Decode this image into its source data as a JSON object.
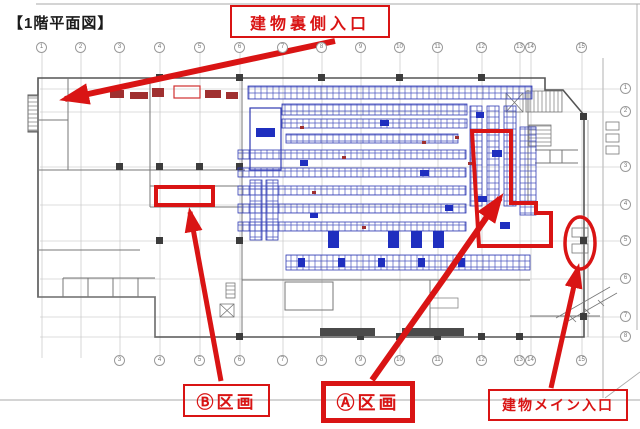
{
  "title": "【1階平面図】",
  "annotations": {
    "back_entrance": "建物裏側入口",
    "section_b": "Ⓑ区画",
    "section_a": "Ⓐ区画",
    "main_entrance": "建物メイン入口"
  },
  "colors": {
    "annotation_red": "#d91414",
    "plan_blue": "#2f3ab2",
    "plan_blue_solid": "#1f2fbf",
    "equipment_red": "#a03030",
    "wall_gray": "#555555",
    "grid_gray": "#9a9a9a"
  },
  "grid": {
    "top_columns": [
      {
        "label": "1",
        "x": 42
      },
      {
        "label": "2",
        "x": 81
      },
      {
        "label": "3",
        "x": 120
      },
      {
        "label": "4",
        "x": 160
      },
      {
        "label": "5",
        "x": 200
      },
      {
        "label": "6",
        "x": 240
      },
      {
        "label": "7",
        "x": 283
      },
      {
        "label": "8",
        "x": 322
      },
      {
        "label": "9",
        "x": 361
      },
      {
        "label": "10",
        "x": 400
      },
      {
        "label": "11",
        "x": 438
      },
      {
        "label": "12",
        "x": 482
      },
      {
        "label": "13",
        "x": 520
      },
      {
        "label": "14",
        "x": 531
      },
      {
        "label": "15",
        "x": 582
      }
    ],
    "bottom_columns": [
      {
        "label": "3",
        "x": 120
      },
      {
        "label": "4",
        "x": 160
      },
      {
        "label": "5",
        "x": 200
      },
      {
        "label": "6",
        "x": 240
      },
      {
        "label": "7",
        "x": 283
      },
      {
        "label": "8",
        "x": 322
      },
      {
        "label": "9",
        "x": 361
      },
      {
        "label": "10",
        "x": 400
      },
      {
        "label": "11",
        "x": 438
      },
      {
        "label": "12",
        "x": 482
      },
      {
        "label": "13",
        "x": 520
      },
      {
        "label": "14",
        "x": 531
      },
      {
        "label": "15",
        "x": 582
      }
    ],
    "right_rows": [
      {
        "label": "1",
        "y": 89
      },
      {
        "label": "2",
        "y": 112
      },
      {
        "label": "3",
        "y": 167
      },
      {
        "label": "4",
        "y": 205
      },
      {
        "label": "5",
        "y": 241
      },
      {
        "label": "6",
        "y": 279
      },
      {
        "label": "7",
        "y": 317
      },
      {
        "label": "8",
        "y": 337
      }
    ]
  }
}
